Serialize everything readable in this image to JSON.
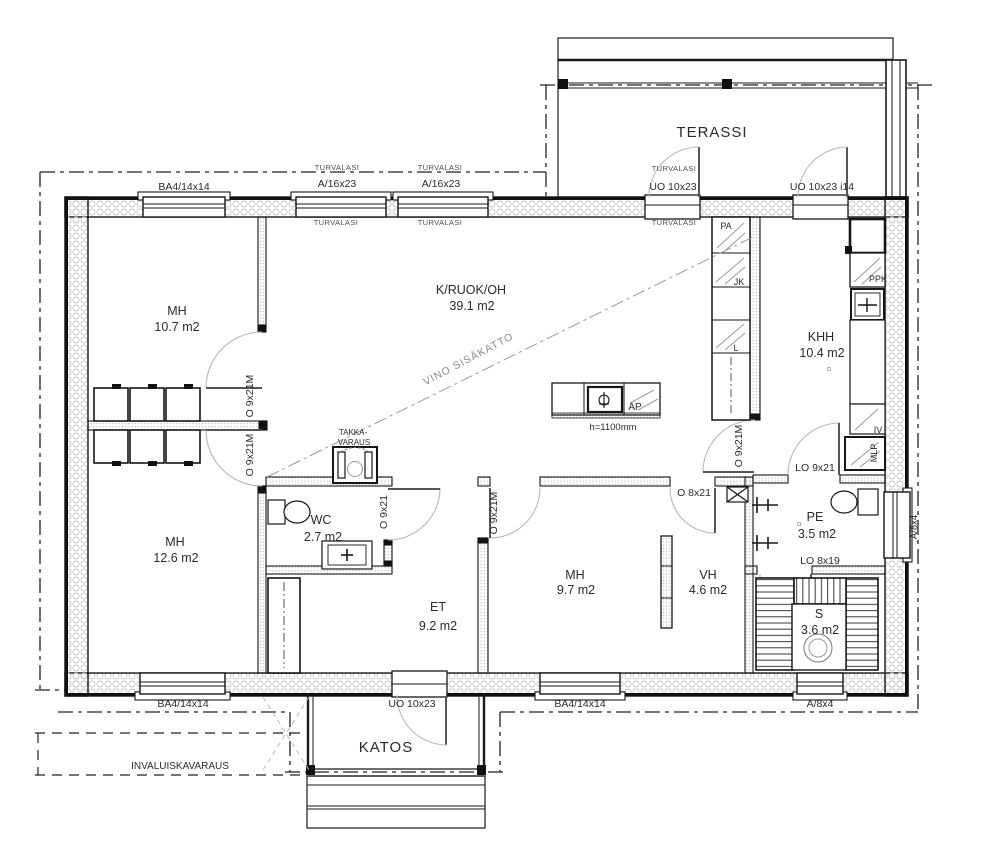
{
  "plan": {
    "rooms": {
      "terassi": {
        "name": "TERASSI"
      },
      "mh1": {
        "name": "MH",
        "area": "10.7 m2"
      },
      "kruokoh": {
        "name": "K/RUOK/OH",
        "area": "39.1 m2"
      },
      "khh": {
        "name": "KHH",
        "area": "10.4 m2"
      },
      "mh2": {
        "name": "MH",
        "area": "12.6 m2"
      },
      "wc": {
        "name": "WC",
        "area": "2.7 m2"
      },
      "et": {
        "name": "ET",
        "area": "9.2 m2"
      },
      "mh3": {
        "name": "MH",
        "area": "9.7 m2"
      },
      "vh": {
        "name": "VH",
        "area": "4.6 m2"
      },
      "pe": {
        "name": "PE",
        "area": "3.5 m2"
      },
      "sauna": {
        "name": "S",
        "area": "3.6 m2"
      },
      "katos": {
        "name": "KATOS"
      }
    },
    "openings": {
      "turvalasi": "TURVALASI",
      "win_top_1": "BA4/14x14",
      "win_top_2": "A/16x23",
      "win_top_3": "A/16x23",
      "door_top_1": "UO 10x23",
      "door_top_2": "UO 10x23 i14",
      "door_mh1": "O 9x21M",
      "door_mh2": "O 9x21M",
      "door_wc": "O 9x21",
      "door_mh3": "O 9x21M",
      "door_vh": "O 8x21",
      "door_khh": "O 9x21M",
      "door_pe": "LO 9x21",
      "door_s": "LO 8x19",
      "win_bot_1": "BA4/14x14",
      "door_bot": "UO 10x23",
      "win_bot_2": "BA4/14x14",
      "win_bot_3": "A/8x4",
      "win_right": "A/8x4"
    },
    "annotations": {
      "vino_sisakatto": "VINO SISÄKATTO",
      "takka_line1": "TAKKA-",
      "takka_line2": "VARAUS",
      "invaluiskavaraus": "INVALUISKAVARAUS",
      "ap": "AP",
      "island_height": "h=1100mm",
      "floor_drain": "¤"
    },
    "appliances": {
      "pa": "PA",
      "jk": "JK",
      "l": "L",
      "ppk": "PPK",
      "iv": "IV",
      "mlp": "MLP"
    },
    "colors": {
      "line": "#161616",
      "door_arc": "#b8b8b8",
      "insulation": "#c6c6c6",
      "annotation_gray": "#8a8a8a"
    }
  }
}
